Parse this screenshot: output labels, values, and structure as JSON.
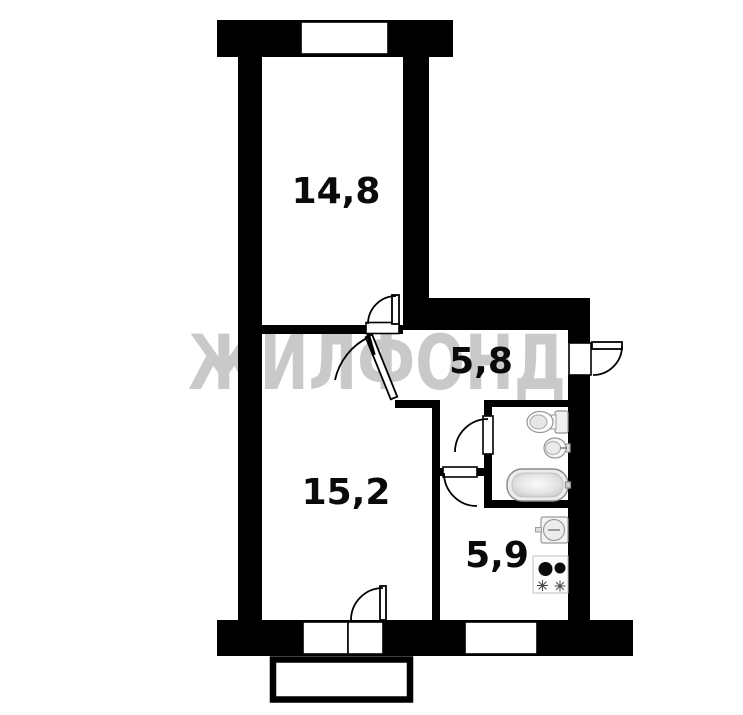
{
  "watermark": "ЖИЛФОНД",
  "rooms": {
    "bedroom": {
      "area": "14,8"
    },
    "living": {
      "area": "15,2"
    },
    "hall": {
      "area": "5,8"
    },
    "kitchen": {
      "area": "5,9"
    }
  },
  "fixtures": {
    "bathroom": [
      "toilet-icon",
      "washbasin-icon",
      "bathtub-icon"
    ],
    "kitchen": [
      "kitchen-sink-icon",
      "stove-icon"
    ]
  },
  "features": [
    "window",
    "balcony",
    "entrance-door",
    "interior-doors"
  ],
  "colors": {
    "wall": "#000000",
    "watermark": "#c9c9c9",
    "background": "#ffffff",
    "label": "#0a0a0a",
    "fixture_outline": "#949494"
  }
}
